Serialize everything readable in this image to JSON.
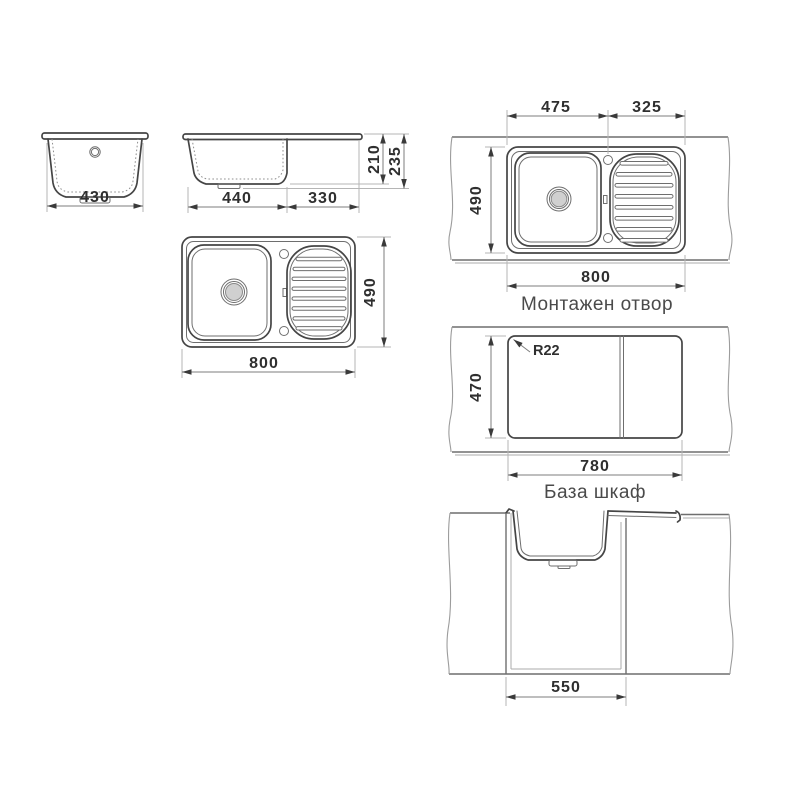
{
  "document": {
    "type": "technical-drawing",
    "subject": "kitchen sink with drainer - installation dimensions",
    "background_color": "#ffffff",
    "line_color": "#454545",
    "dimension_text_color": "#2f2f2f",
    "caption_color": "#4a4a4a",
    "drain_fill_color": "#d0d0d0"
  },
  "views": {
    "front": {
      "bowl_width": "430"
    },
    "side": {
      "bowl_width": "440",
      "drainer_width": "330",
      "bowl_depth": "210",
      "total_height": "235"
    },
    "top": {
      "overall_width": "800",
      "overall_depth": "490"
    },
    "mounted": {
      "caption": "Монтажен отвор",
      "bowl_axis": "475",
      "drainer_axis": "325",
      "overall_depth": "490",
      "overall_width": "800"
    },
    "cutout": {
      "caption": "База шкаф",
      "corner_radius": "R22",
      "cutout_depth": "470",
      "cutout_width": "780"
    },
    "cabinet": {
      "opening_width": "550"
    }
  }
}
